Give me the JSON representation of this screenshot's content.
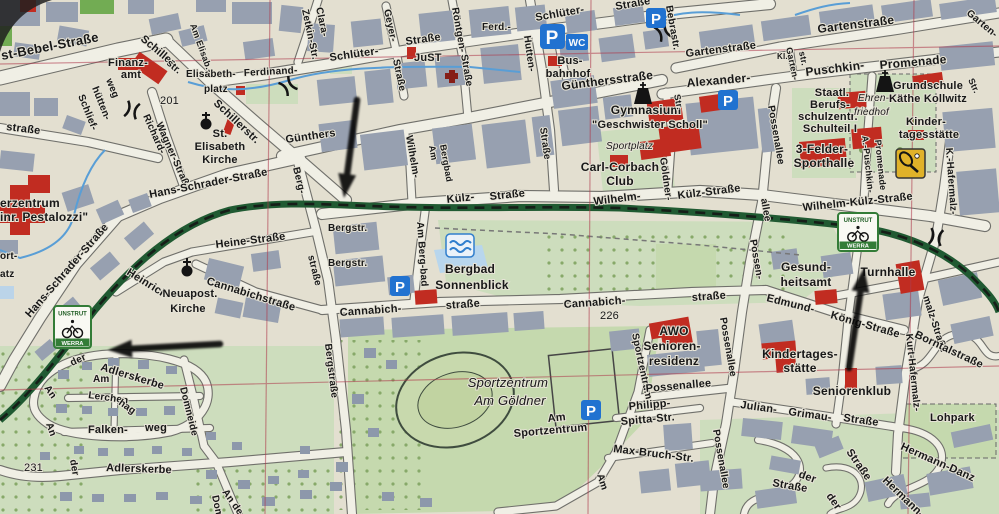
{
  "meta": {
    "description": "Photograph of a printed German city street map with three hand-drawn black arrows and Unstrut-Werra cycle-route signs"
  },
  "palette": {
    "paper": "#e6e2d2",
    "building": "#97a1b2",
    "street": "#f4f2e8",
    "street_casing": "#70706a",
    "green_area": "#cfe0bd",
    "green_dark": "#c6dcae",
    "green_bright": "#6fae4e",
    "route_green": "#1b5a2e",
    "red_building": "#c9281c",
    "blue_icon": "#1a72d8",
    "water": "#55a0dc",
    "grid_red": "#b5374b",
    "label": "#151515",
    "sign_green": "#2e7d32"
  },
  "icons": {
    "parking_label": "P",
    "wc_label": "WC"
  },
  "route_sign": {
    "top": "UNSTRUT",
    "bottom": "WERRA"
  },
  "labels": [
    {
      "t": "st-Bebel-Straße",
      "x": 2,
      "y": 60,
      "r": -11,
      "s": 13
    },
    {
      "t": "straße",
      "x": 6,
      "y": 130,
      "r": 7
    },
    {
      "t": "Schlief-",
      "x": 78,
      "y": 96,
      "r": 68,
      "s": 10
    },
    {
      "t": "hütten-",
      "x": 92,
      "y": 88,
      "r": 68,
      "s": 10
    },
    {
      "t": "weg",
      "x": 106,
      "y": 80,
      "r": 68,
      "s": 10
    },
    {
      "t": "Finanz-",
      "x": 128,
      "y": 66,
      "a": "m"
    },
    {
      "t": "amt",
      "x": 131,
      "y": 78,
      "a": "m"
    },
    {
      "t": "Schiller-",
      "x": 140,
      "y": 40,
      "r": 40
    },
    {
      "t": "str.",
      "x": 166,
      "y": 64,
      "r": 40,
      "s": 10
    },
    {
      "t": "Richard-",
      "x": 143,
      "y": 116,
      "r": 66,
      "s": 10
    },
    {
      "t": "Wagner-Straße",
      "x": 156,
      "y": 124,
      "r": 66,
      "s": 10
    },
    {
      "t": "201",
      "x": 160,
      "y": 104,
      "n": 1
    },
    {
      "t": "Elisabeth-",
      "x": 186,
      "y": 77,
      "s": 10
    },
    {
      "t": "platz",
      "x": 204,
      "y": 92,
      "s": 10
    },
    {
      "t": "Am Elisab.-",
      "x": 190,
      "y": 25,
      "r": 70,
      "s": 9
    },
    {
      "t": "Schillerstr.",
      "x": 213,
      "y": 104,
      "r": 43
    },
    {
      "t": "St.",
      "x": 220,
      "y": 137,
      "a": "m"
    },
    {
      "t": "Elisabeth",
      "x": 220,
      "y": 150,
      "a": "m"
    },
    {
      "t": "Kirche",
      "x": 220,
      "y": 163,
      "a": "m"
    },
    {
      "t": "Ferdinand-",
      "x": 244,
      "y": 76,
      "r": -3,
      "s": 10
    },
    {
      "t": "Clara-",
      "x": 316,
      "y": 8,
      "r": 78,
      "s": 10
    },
    {
      "t": "Zetkin-Str.",
      "x": 302,
      "y": 10,
      "r": 78,
      "s": 10
    },
    {
      "t": "Günthers",
      "x": 286,
      "y": 143,
      "r": -8
    },
    {
      "t": "Hans-Schrader-Straße",
      "x": 150,
      "y": 198,
      "r": -11
    },
    {
      "t": "Hans-Schrader-Straße",
      "x": 30,
      "y": 318,
      "r": -49
    },
    {
      "t": "erzentrum",
      "x": 0,
      "y": 207,
      "s": 12
    },
    {
      "t": "inr. Pestalozzi\"",
      "x": 0,
      "y": 221,
      "s": 12
    },
    {
      "t": "ort-",
      "x": 0,
      "y": 259,
      "s": 10
    },
    {
      "t": "atz",
      "x": 0,
      "y": 277,
      "s": 10
    },
    {
      "t": "Heinrich-",
      "x": 126,
      "y": 274,
      "r": 32
    },
    {
      "t": "Heine-Straße",
      "x": 216,
      "y": 248,
      "r": -7
    },
    {
      "t": "Neuapost.",
      "x": 190,
      "y": 297,
      "a": "m"
    },
    {
      "t": "Kirche",
      "x": 188,
      "y": 312,
      "a": "m"
    },
    {
      "t": "Cannabichstraße",
      "x": 206,
      "y": 284,
      "r": 17
    },
    {
      "t": "Berg-",
      "x": 293,
      "y": 168,
      "r": 76,
      "s": 10
    },
    {
      "t": "Bergstr.",
      "x": 328,
      "y": 231,
      "s": 10
    },
    {
      "t": "Bergstr.",
      "x": 328,
      "y": 266,
      "s": 10
    },
    {
      "t": "straße",
      "x": 308,
      "y": 256,
      "r": 76,
      "s": 10
    },
    {
      "t": "Bergstraße",
      "x": 325,
      "y": 344,
      "r": 83,
      "s": 10
    },
    {
      "t": "Schlüter-",
      "x": 330,
      "y": 61,
      "r": -8
    },
    {
      "t": "Straße",
      "x": 406,
      "y": 45,
      "r": -8
    },
    {
      "t": "JuST",
      "x": 414,
      "y": 61
    },
    {
      "t": "Geyer-",
      "x": 384,
      "y": 10,
      "r": 78,
      "s": 10
    },
    {
      "t": "Straße",
      "x": 393,
      "y": 60,
      "r": 78,
      "s": 10
    },
    {
      "t": "Röntgen-",
      "x": 452,
      "y": 8,
      "r": 80,
      "s": 10
    },
    {
      "t": "Straße",
      "x": 461,
      "y": 55,
      "r": 80,
      "s": 10
    },
    {
      "t": "Ferd.-",
      "x": 482,
      "y": 30,
      "s": 10
    },
    {
      "t": "Hutten-",
      "x": 524,
      "y": 36,
      "r": 82,
      "s": 10
    },
    {
      "t": "Straße",
      "x": 540,
      "y": 128,
      "r": 82,
      "s": 10
    },
    {
      "t": "Schlüter-",
      "x": 536,
      "y": 21,
      "r": -10
    },
    {
      "t": "Straße",
      "x": 616,
      "y": 10,
      "r": -10
    },
    {
      "t": "Bus-",
      "x": 570,
      "y": 64,
      "a": "m"
    },
    {
      "t": "bahnhof",
      "x": 568,
      "y": 77,
      "a": "m"
    },
    {
      "t": "Günthersstraße",
      "x": 562,
      "y": 90,
      "r": -7,
      "s": 12
    },
    {
      "t": "Wilhelm-",
      "x": 406,
      "y": 136,
      "r": 80,
      "s": 10
    },
    {
      "t": "Am",
      "x": 429,
      "y": 146,
      "r": 80,
      "s": 9
    },
    {
      "t": "Bergbad",
      "x": 440,
      "y": 145,
      "r": 80,
      "s": 9
    },
    {
      "t": "Am Berg-bad",
      "x": 417,
      "y": 222,
      "r": 86,
      "s": 10
    },
    {
      "t": "Külz-",
      "x": 447,
      "y": 203,
      "r": -6
    },
    {
      "t": "Straße",
      "x": 490,
      "y": 200,
      "r": -6
    },
    {
      "t": "Bergbad",
      "x": 470,
      "y": 273,
      "a": "m",
      "s": 12
    },
    {
      "t": "Sonnenblick",
      "x": 472,
      "y": 289,
      "a": "m",
      "s": 12
    },
    {
      "t": "Cannabich-",
      "x": 340,
      "y": 316,
      "r": -4
    },
    {
      "t": "straße",
      "x": 446,
      "y": 309,
      "r": -4
    },
    {
      "t": "Sportzentrum",
      "x": 508,
      "y": 387,
      "a": "m",
      "s": 13,
      "i": 1,
      "n": 1
    },
    {
      "t": "Am Göldner",
      "x": 510,
      "y": 405,
      "a": "m",
      "s": 13,
      "i": 1,
      "n": 1
    },
    {
      "t": "Am",
      "x": 548,
      "y": 422,
      "r": -6
    },
    {
      "t": "Sportzentrum",
      "x": 514,
      "y": 437,
      "r": -5
    },
    {
      "t": "Sportzentrum",
      "x": 632,
      "y": 334,
      "r": 78,
      "s": 10
    },
    {
      "t": "Am",
      "x": 597,
      "y": 475,
      "r": 72,
      "s": 10
    },
    {
      "t": "Philipp-",
      "x": 629,
      "y": 410,
      "r": -5
    },
    {
      "t": "Spitta-Str.",
      "x": 621,
      "y": 425,
      "r": -5
    },
    {
      "t": "Max-Bruch-Str.",
      "x": 613,
      "y": 452,
      "r": 7
    },
    {
      "t": "Cannabich-",
      "x": 564,
      "y": 308,
      "r": -4
    },
    {
      "t": "226",
      "x": 600,
      "y": 319,
      "n": 1
    },
    {
      "t": "straße",
      "x": 692,
      "y": 301,
      "r": -4
    },
    {
      "t": "AWO",
      "x": 674,
      "y": 335,
      "a": "m",
      "s": 12
    },
    {
      "t": "Senioren-",
      "x": 672,
      "y": 350,
      "a": "m",
      "s": 12
    },
    {
      "t": "residenz",
      "x": 674,
      "y": 365,
      "a": "m",
      "s": 12
    },
    {
      "t": "Bebrastr.",
      "x": 666,
      "y": 6,
      "r": 80,
      "s": 10
    },
    {
      "t": "Gartenstraße",
      "x": 686,
      "y": 57,
      "r": -7
    },
    {
      "t": "Gartenstraße",
      "x": 818,
      "y": 33,
      "r": -7,
      "s": 12
    },
    {
      "t": "Garten-",
      "x": 966,
      "y": 14,
      "r": 40,
      "s": 10
    },
    {
      "t": "Alexander-",
      "x": 687,
      "y": 87,
      "r": -5,
      "s": 12
    },
    {
      "t": "Kl.",
      "x": 777,
      "y": 59,
      "s": 8
    },
    {
      "t": "Garten-",
      "x": 786,
      "y": 48,
      "r": 78,
      "s": 9
    },
    {
      "t": "str.",
      "x": 799,
      "y": 52,
      "r": 78,
      "s": 9
    },
    {
      "t": "Puschkin-",
      "x": 806,
      "y": 76,
      "r": -7,
      "s": 12
    },
    {
      "t": "Promenade",
      "x": 880,
      "y": 69,
      "r": -5,
      "s": 12
    },
    {
      "t": "Possenallee",
      "x": 768,
      "y": 106,
      "r": 80,
      "s": 10
    },
    {
      "t": "Str.",
      "x": 968,
      "y": 80,
      "r": 65,
      "s": 9
    },
    {
      "t": "Staatl.",
      "x": 832,
      "y": 96,
      "a": "m"
    },
    {
      "t": "Berufs-",
      "x": 830,
      "y": 108,
      "a": "m"
    },
    {
      "t": "schulzentr.",
      "x": 828,
      "y": 120,
      "a": "m"
    },
    {
      "t": "Schulteil I",
      "x": 830,
      "y": 132,
      "a": "m"
    },
    {
      "t": "Ehren-",
      "x": 858,
      "y": 101,
      "s": 10,
      "i": 1,
      "n": 1
    },
    {
      "t": "friedhof",
      "x": 854,
      "y": 115,
      "s": 10,
      "i": 1,
      "n": 1
    },
    {
      "t": "Grundschule",
      "x": 928,
      "y": 89,
      "a": "m"
    },
    {
      "t": "Käthe Kollwitz",
      "x": 928,
      "y": 102,
      "a": "m"
    },
    {
      "t": "Kinder-",
      "x": 926,
      "y": 125,
      "a": "m"
    },
    {
      "t": "tagesstätte",
      "x": 929,
      "y": 138,
      "a": "m"
    },
    {
      "t": "3-Felder-",
      "x": 822,
      "y": 153,
      "a": "m",
      "s": 12
    },
    {
      "t": "Sporthalle",
      "x": 824,
      "y": 167,
      "a": "m",
      "s": 12
    },
    {
      "t": "Külz-Straße",
      "x": 678,
      "y": 199,
      "r": -7
    },
    {
      "t": "Wilhelm-",
      "x": 594,
      "y": 205,
      "r": -7
    },
    {
      "t": "Wilhelm-Külz-Straße",
      "x": 803,
      "y": 211,
      "r": -6
    },
    {
      "t": "A.-Puschkin-",
      "x": 862,
      "y": 136,
      "r": 84,
      "s": 9
    },
    {
      "t": "Promenade",
      "x": 875,
      "y": 140,
      "r": 84,
      "s": 9
    },
    {
      "t": "K.-Hafermalz-",
      "x": 946,
      "y": 148,
      "r": 86,
      "s": 10
    },
    {
      "t": "allee",
      "x": 761,
      "y": 199,
      "r": 80,
      "s": 10
    },
    {
      "t": "Possen-",
      "x": 750,
      "y": 240,
      "r": 80,
      "s": 10
    },
    {
      "t": "Gesund-",
      "x": 806,
      "y": 271,
      "a": "m",
      "s": 12
    },
    {
      "t": "heitsamt",
      "x": 806,
      "y": 286,
      "a": "m",
      "s": 12
    },
    {
      "t": "Turnhalle",
      "x": 888,
      "y": 276,
      "a": "m",
      "s": 12
    },
    {
      "t": "Edmund-",
      "x": 766,
      "y": 301,
      "r": 14
    },
    {
      "t": "König-Straße",
      "x": 830,
      "y": 318,
      "r": 16
    },
    {
      "t": "Possenallee",
      "x": 646,
      "y": 392,
      "r": -5
    },
    {
      "t": "Possenallee",
      "x": 720,
      "y": 318,
      "r": 80,
      "s": 10
    },
    {
      "t": "Possenallee",
      "x": 713,
      "y": 430,
      "r": 80,
      "s": 10
    },
    {
      "t": "Julian-",
      "x": 740,
      "y": 408,
      "r": 8
    },
    {
      "t": "Grimau-",
      "x": 788,
      "y": 415,
      "r": 8
    },
    {
      "t": "Straße",
      "x": 843,
      "y": 421,
      "r": 8
    },
    {
      "t": "Kindertages-",
      "x": 800,
      "y": 358,
      "a": "m",
      "s": 12
    },
    {
      "t": "stätte",
      "x": 800,
      "y": 372,
      "a": "m",
      "s": 12
    },
    {
      "t": "Seniorenklub",
      "x": 852,
      "y": 395,
      "a": "m",
      "s": 12
    },
    {
      "t": "Kurt-Hafermalz-",
      "x": 906,
      "y": 334,
      "r": 84,
      "s": 10
    },
    {
      "t": "malz-Straße",
      "x": 923,
      "y": 297,
      "r": 72,
      "s": 10
    },
    {
      "t": "Borntalstraße",
      "x": 914,
      "y": 337,
      "r": 25
    },
    {
      "t": "Lohpark",
      "x": 930,
      "y": 421
    },
    {
      "t": "Hermann-Danz",
      "x": 900,
      "y": 449,
      "r": 24
    },
    {
      "t": "Hermann-",
      "x": 882,
      "y": 481,
      "r": 44
    },
    {
      "t": "Straße",
      "x": 846,
      "y": 452,
      "r": 55
    },
    {
      "t": "der",
      "x": 798,
      "y": 477,
      "r": 20
    },
    {
      "t": "Straße",
      "x": 772,
      "y": 486,
      "r": 10
    },
    {
      "t": "der",
      "x": 826,
      "y": 496,
      "r": 55
    },
    {
      "t": "An",
      "x": 44,
      "y": 388,
      "r": 55,
      "s": 10
    },
    {
      "t": "der",
      "x": 72,
      "y": 366,
      "r": -25,
      "s": 10
    },
    {
      "t": "Adlerskerbe",
      "x": 100,
      "y": 370,
      "r": 17
    },
    {
      "t": "Am",
      "x": 93,
      "y": 382,
      "s": 10
    },
    {
      "t": "Lerchen",
      "x": 88,
      "y": 398,
      "r": 8,
      "s": 10
    },
    {
      "t": "hag",
      "x": 118,
      "y": 404,
      "r": 35,
      "s": 10
    },
    {
      "t": "An",
      "x": 46,
      "y": 424,
      "r": 70,
      "s": 10
    },
    {
      "t": "der",
      "x": 70,
      "y": 460,
      "r": 80,
      "s": 10
    },
    {
      "t": "Falken-",
      "x": 88,
      "y": 433
    },
    {
      "t": "weg",
      "x": 145,
      "y": 431
    },
    {
      "t": "231",
      "x": 24,
      "y": 471,
      "n": 1
    },
    {
      "t": "Adlerskerbe",
      "x": 106,
      "y": 471,
      "r": 2
    },
    {
      "t": "Domneide",
      "x": 180,
      "y": 388,
      "r": 76,
      "s": 10
    },
    {
      "t": "An de",
      "x": 222,
      "y": 492,
      "r": 55,
      "s": 10
    },
    {
      "t": "Domn",
      "x": 212,
      "y": 496,
      "r": 78,
      "s": 10
    },
    {
      "t": "Gymnasium",
      "x": 646,
      "y": 114,
      "a": "m",
      "s": 12
    },
    {
      "t": "\"Geschwister Scholl\"",
      "x": 650,
      "y": 128,
      "a": "m"
    },
    {
      "t": "Sportplatz",
      "x": 606,
      "y": 149,
      "s": 10,
      "i": 1,
      "n": 1
    },
    {
      "t": "Carl-Corbach",
      "x": 620,
      "y": 171,
      "a": "m",
      "s": 12
    },
    {
      "t": "Club",
      "x": 620,
      "y": 185,
      "a": "m",
      "s": 12
    },
    {
      "t": "Göldner-",
      "x": 660,
      "y": 158,
      "r": 82,
      "s": 10
    },
    {
      "t": "Str.",
      "x": 674,
      "y": 95,
      "r": 78,
      "s": 9
    }
  ],
  "arrows": [
    {
      "from": [
        357,
        100
      ],
      "to": [
        344,
        198
      ]
    },
    {
      "from": [
        220,
        344
      ],
      "to": [
        108,
        350
      ]
    },
    {
      "from": [
        849,
        368
      ],
      "to": [
        864,
        268
      ]
    }
  ]
}
